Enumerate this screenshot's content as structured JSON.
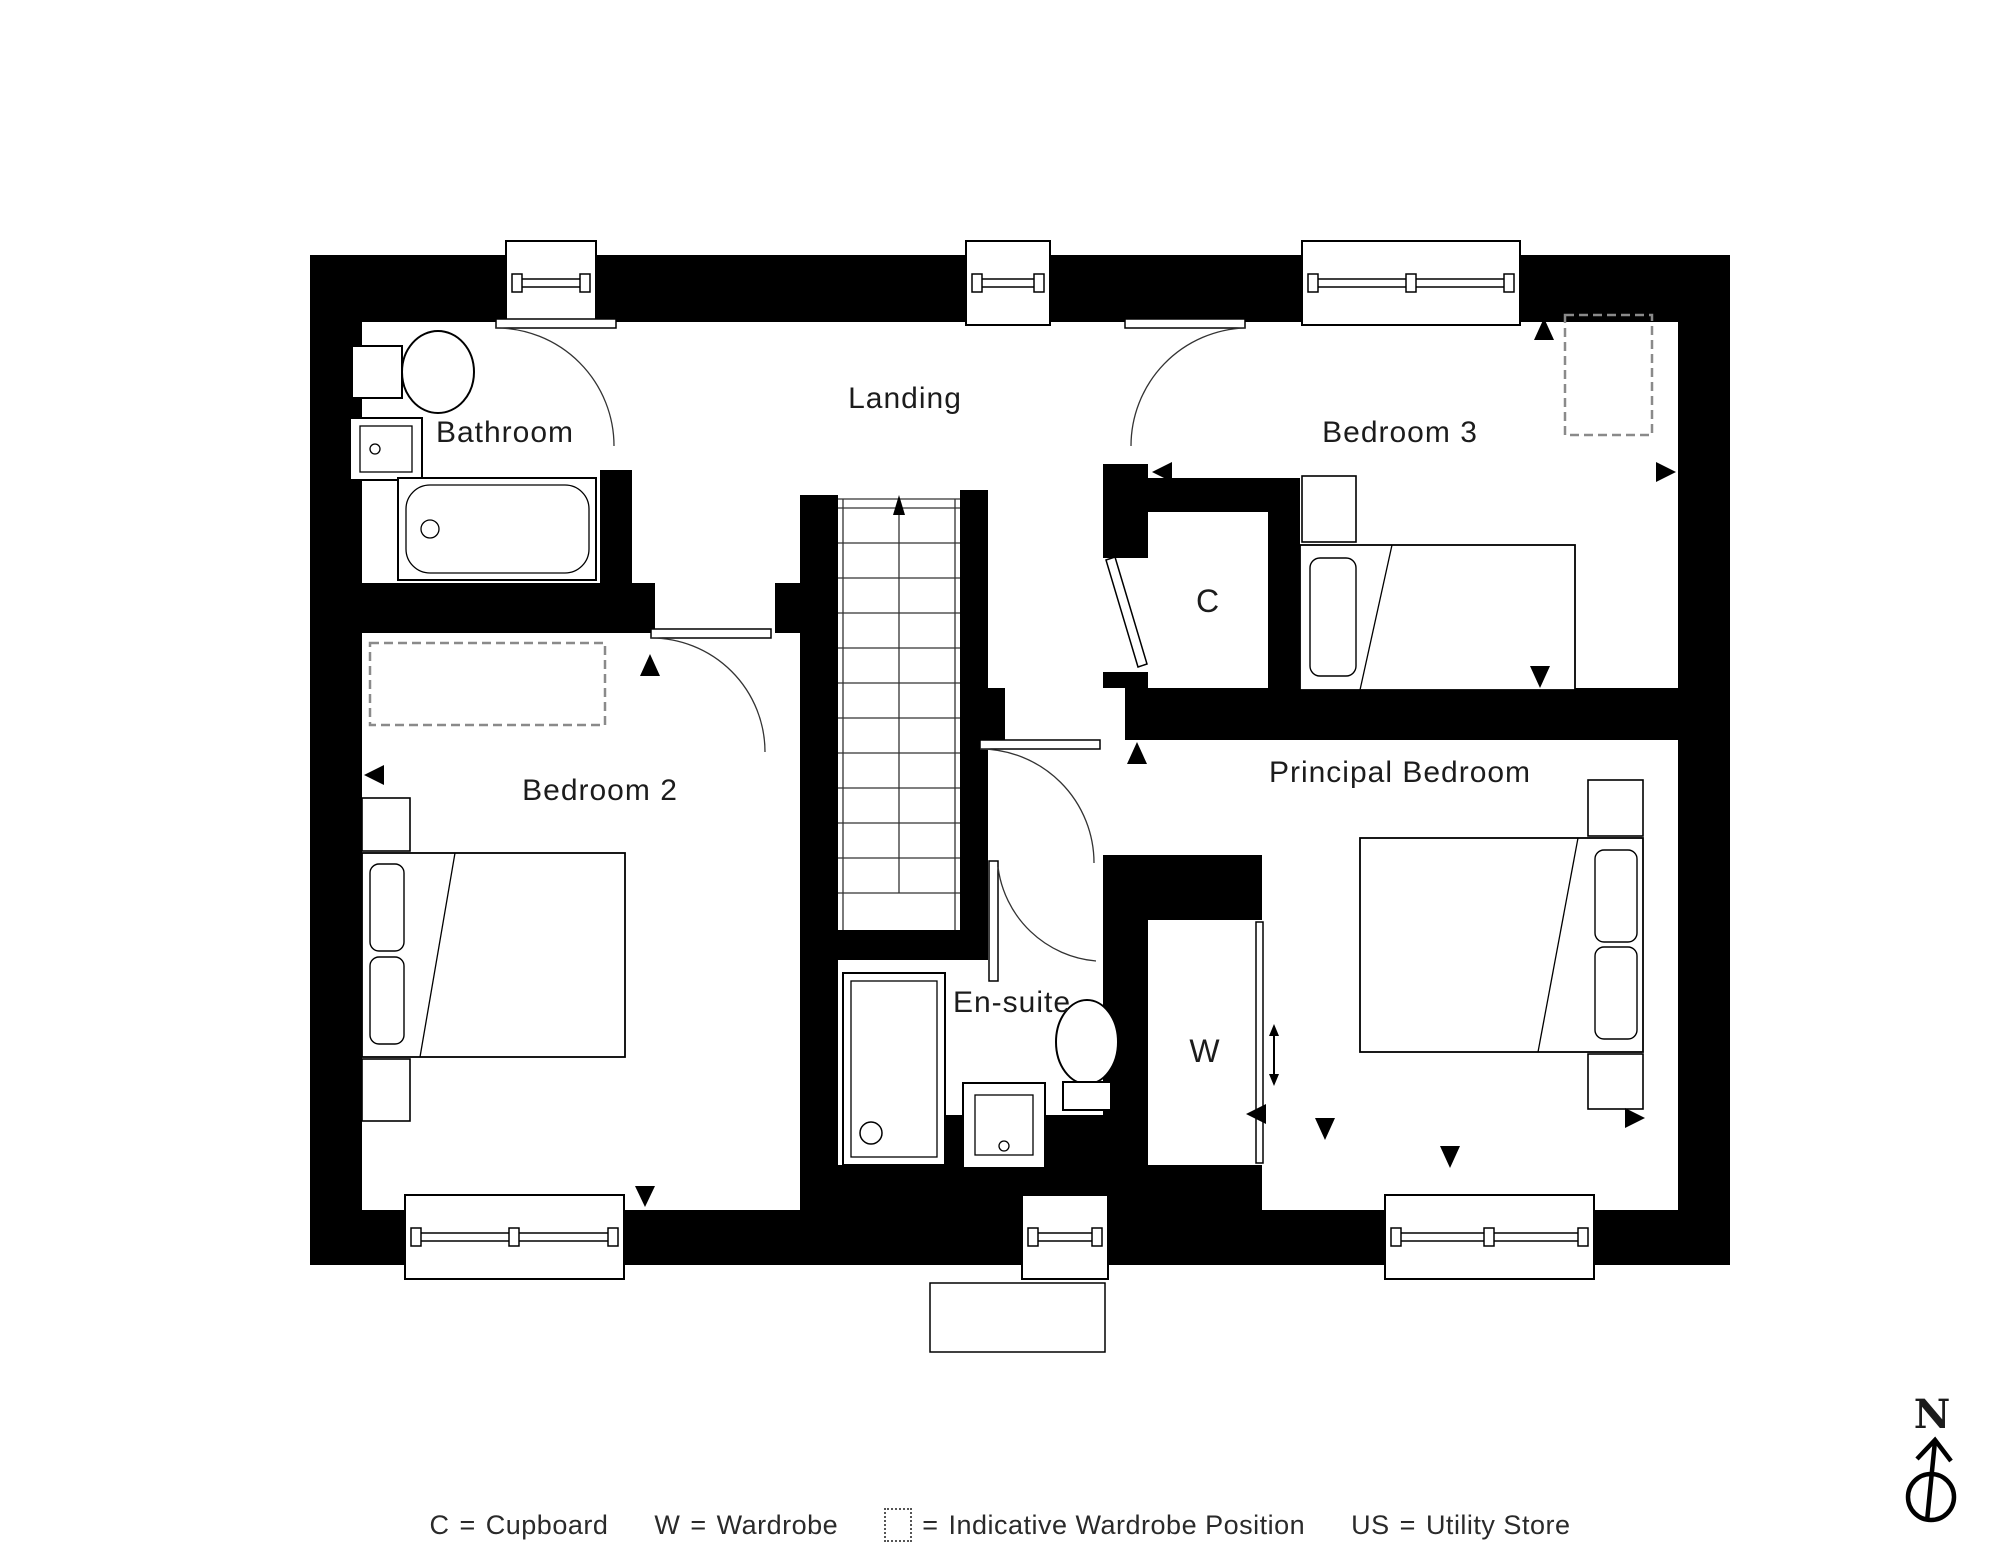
{
  "plan": {
    "rooms": [
      {
        "name": "Bathroom"
      },
      {
        "name": "Landing"
      },
      {
        "name": "Bedroom 3"
      },
      {
        "name": "Bedroom 2"
      },
      {
        "name": "Principal Bedroom"
      },
      {
        "name": "En-suite"
      }
    ],
    "labels": {
      "cupboard": "C",
      "wardrobe": "W"
    }
  },
  "legend": {
    "items": [
      {
        "symbol": "C",
        "eq": "=",
        "label": "Cupboard"
      },
      {
        "symbol": "W",
        "eq": "=",
        "label": "Wardrobe"
      },
      {
        "symbol": "",
        "eq": "=",
        "label": "Indicative Wardrobe Position"
      },
      {
        "symbol": "US",
        "eq": "=",
        "label": "Utility Store"
      }
    ]
  },
  "compass": {
    "north_label": "N"
  }
}
